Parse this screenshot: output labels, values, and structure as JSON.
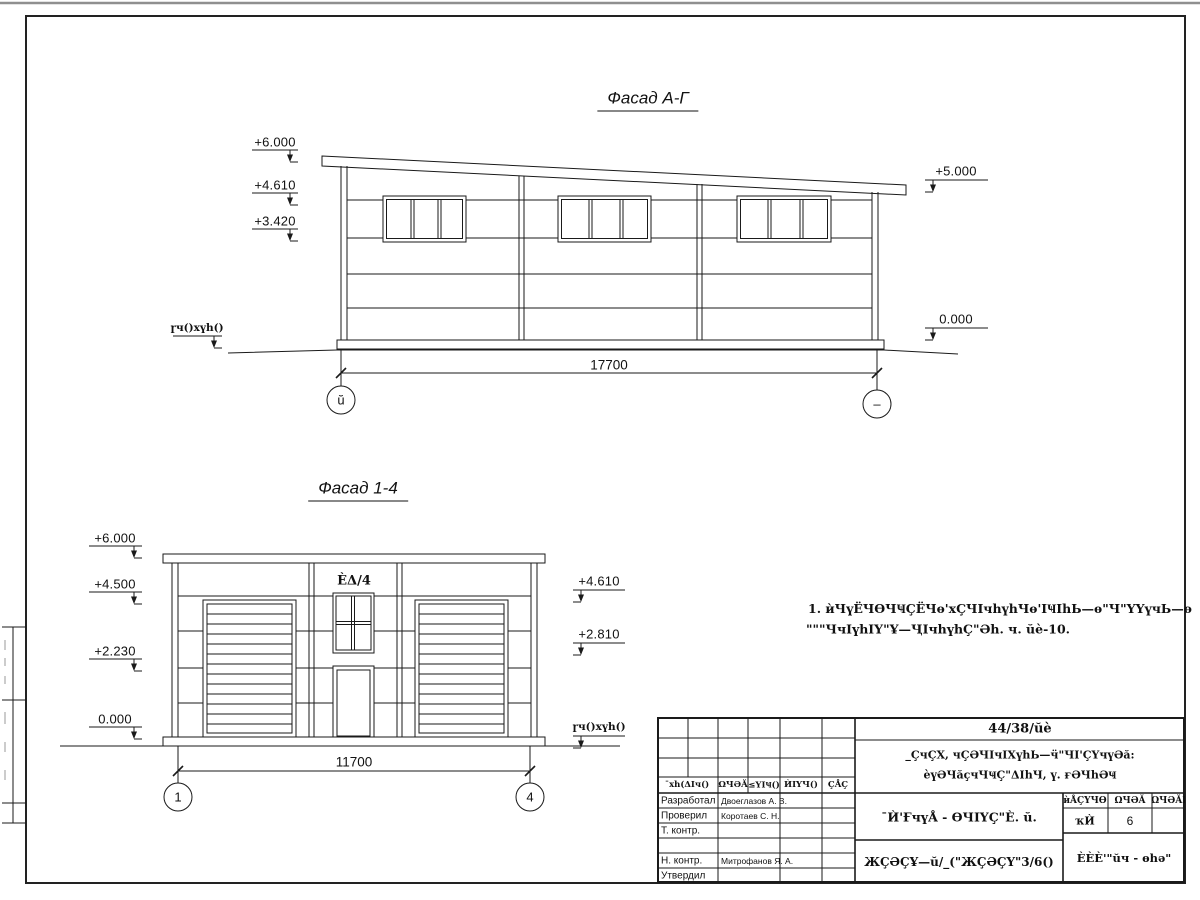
{
  "facade_ag": {
    "title": "Фасад А-Г",
    "elev_left": [
      "+6.000",
      "+4.610",
      "+3.420"
    ],
    "elev_right": [
      "+5.000",
      "0.000"
    ],
    "ground": "ɼч()хүh()",
    "dim": "17700",
    "axis_left": "ŭ",
    "axis_right": "–"
  },
  "facade_14": {
    "title": "Фасад 1-4",
    "elev_left": [
      "+6.000",
      "+4.500",
      "+2.230",
      "0.000"
    ],
    "elev_right": [
      "+4.610",
      "+2.810"
    ],
    "ground": "ɼч()хүh()",
    "dim": "11700",
    "axis_left": "1",
    "axis_right": "4",
    "window_label": "ÈΔ/4"
  },
  "note": {
    "line1": "1. ѝЧүЁЧѲЧҸÇЁЧѳ'хÇЧӀчhүhЧѳ'ӀҸӀhЬ—ѳ\"Ч\"ҮҮүчЬ—ѳ",
    "line2": "\"\"\"ЧчӀүhӀҮ\"Ұ—ҶӀчhүhÇ\"Әh. ч. ŭè-10."
  },
  "title_block": {
    "doc_number": "44/38/ŭè",
    "project_line1": "_ÇчÇХ, чÇӘЧӀчӀХүhЬ—ӵ\"ЧӀ'ÇҮчүӘă:",
    "project_line2": "èүӘЧăçчЧҸÇ\"ΔӀhЧ, ү. ғӘЧhӘҸ",
    "columns": [
      "¯хh(ΔӀч()",
      "ΩЧӘĂ",
      "≤ҮӀҸ()",
      "ЍӀҮЧ()",
      "ÇÅÇ"
    ],
    "signature_rows": [
      {
        "label": "Разработал",
        "name": "Двоеглазов А. В."
      },
      {
        "label": "Проверил",
        "name": "Коротаев С. Н."
      },
      {
        "label": "Т. контр.",
        "name": ""
      },
      {
        "label": "",
        "name": ""
      },
      {
        "label": "Н. контр.",
        "name": "Митрофанов Я. А."
      },
      {
        "label": "Утвердил",
        "name": ""
      }
    ],
    "sheet_title": "¯Ѝ'ҒчүÅ - ѲЧӀҮÇ\"È. ŭ.",
    "doc_type": "ЖÇӘÇҰ—ŭ/_(\"ЖÇӘÇҮ\"3/6()",
    "company": "ÈÈÈ'\"ŭч - ѳhә\"",
    "stage_table": {
      "headers": [
        "ѝÅÇҮЧѲ",
        "ΩЧӘĂ",
        "ΩЧӘĂӀҮ"
      ],
      "stage": "ҡЍ",
      "sheet": "6",
      "sheets": ""
    }
  }
}
